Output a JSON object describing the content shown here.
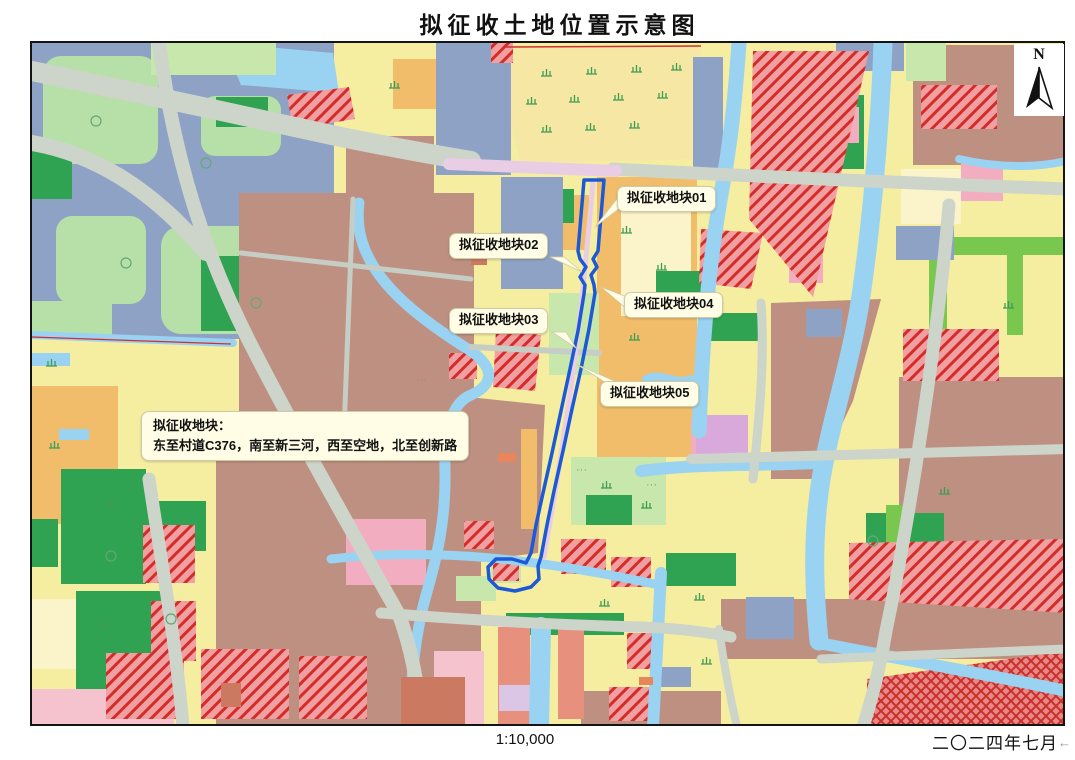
{
  "title": "拟征收土地位置示意图",
  "map": {
    "north_label": "N",
    "plot_labels": [
      {
        "label": "拟征收地块01"
      },
      {
        "label": "拟征收地块02"
      },
      {
        "label": "拟征收地块03"
      },
      {
        "label": "拟征收地块04"
      },
      {
        "label": "拟征收地块05"
      }
    ],
    "boundary_note": {
      "line1": "拟征收地块：",
      "line2": "东至村道C376，南至新三河，西至空地，北至创新路"
    },
    "dots": "···",
    "colors": {
      "boundary_blue": "#1C59D6",
      "water": "#9AD2F2",
      "road_gray": "#CDD4C9",
      "road_pink": "#E9CDE5",
      "parcel_yellow": "#F5EDA0",
      "parcel_orange": "#F1BD6B",
      "parcel_brown": "#BE9082",
      "parcel_green": "#2FA351",
      "parcel_slate": "#8EA2C6",
      "hatch_red": "#D42B2B",
      "callout_bg": "#FFFDE6"
    }
  },
  "footer": {
    "scale": "1:10,000",
    "date": "二〇二四年七月",
    "corner_arrow": "←"
  }
}
